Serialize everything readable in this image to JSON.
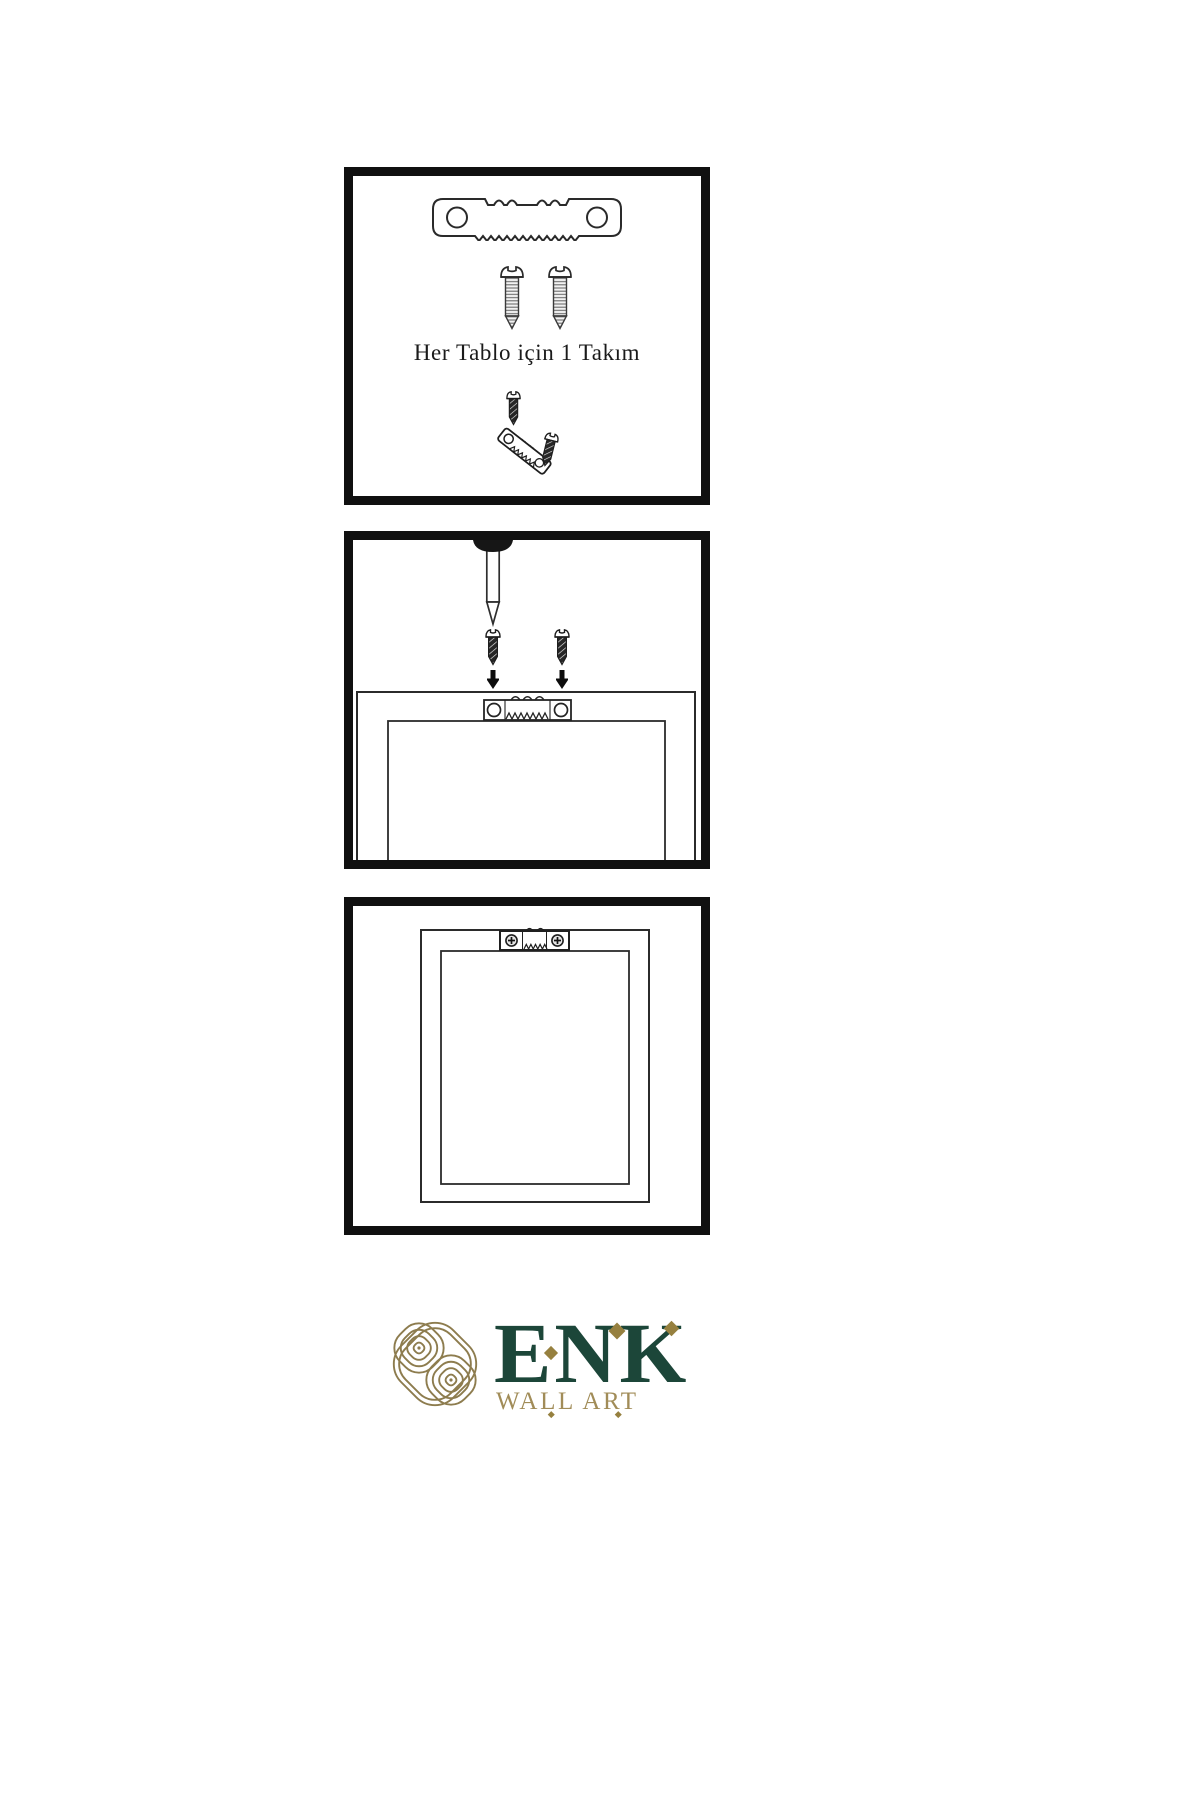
{
  "page": {
    "background": "#ffffff",
    "outline_color": "#101010"
  },
  "panels": [
    {
      "name": "hardware-kit",
      "caption": "Her Tablo için 1 Takım",
      "icons": [
        "sawtooth-hanger",
        "screw",
        "screw",
        "screw-driven-into-sawtooth-hanger"
      ]
    },
    {
      "name": "wall-mounting",
      "icons": [
        "nail-in-wall",
        "screw",
        "screw",
        "down-arrow",
        "down-arrow",
        "frame-back",
        "sawtooth-hanger-on-frame"
      ]
    },
    {
      "name": "hung-frame",
      "icons": [
        "frame-back",
        "sawtooth-hanger-installed"
      ]
    }
  ],
  "logo": {
    "brand": "ENK",
    "subtitle": "WALL ART",
    "brand_color": "#1c4639",
    "subtitle_color": "#a18c58",
    "emblem_color": "#8d7c4e",
    "accent_diamond_color": "#96803f"
  }
}
